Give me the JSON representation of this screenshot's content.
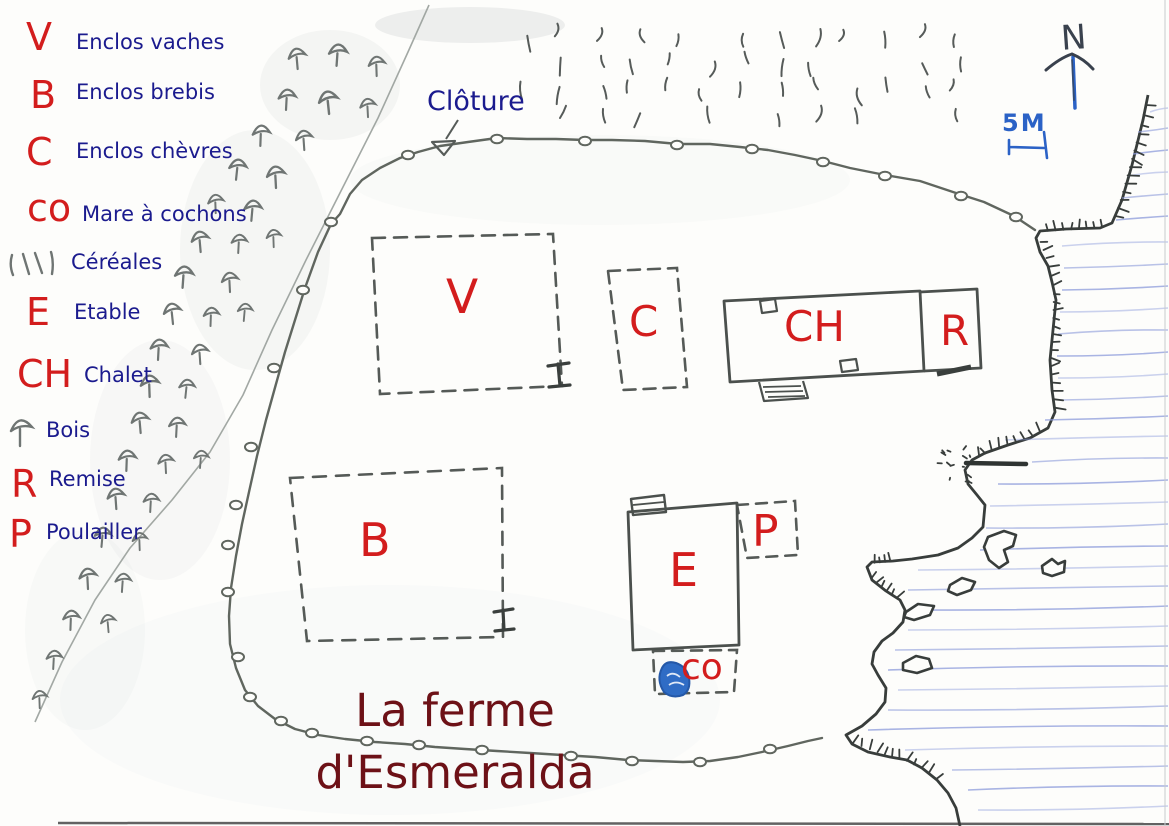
{
  "title": {
    "line1": "La ferme",
    "line2": "d'Esmeralda"
  },
  "legend": {
    "items": [
      {
        "key": "V",
        "label": "Enclos vaches"
      },
      {
        "key": "B",
        "label": "Enclos brebis"
      },
      {
        "key": "C",
        "label": "Enclos chèvres"
      },
      {
        "key": "co",
        "label": "Mare à cochons"
      },
      {
        "key": "",
        "label": "Céréales",
        "icon": "cereal-hatching-icon"
      },
      {
        "key": "E",
        "label": "Etable"
      },
      {
        "key": "CH",
        "label": "Chalet"
      },
      {
        "key": "",
        "label": "Bois",
        "icon": "tree-icon"
      },
      {
        "key": "R",
        "label": "Remise"
      },
      {
        "key": "P",
        "label": "Poulailler"
      }
    ]
  },
  "map": {
    "fence_label": "Clôture",
    "area_labels": {
      "vaches": "V",
      "chevres": "C",
      "chalet": "CH",
      "remise": "R",
      "brebis": "B",
      "etable": "E",
      "poulailler": "P",
      "mare": "co"
    },
    "compass_north": "N",
    "scale_label": "5M"
  },
  "colors": {
    "legend_key_red": "#d31d1d",
    "label_navy": "#1b1b8e",
    "title_maroon": "#6d1117",
    "ink_gray": "#565b58",
    "shore_ink": "#383d3b",
    "water_blue": "#8c9bdb",
    "pen_blue": "#2b62c6"
  }
}
